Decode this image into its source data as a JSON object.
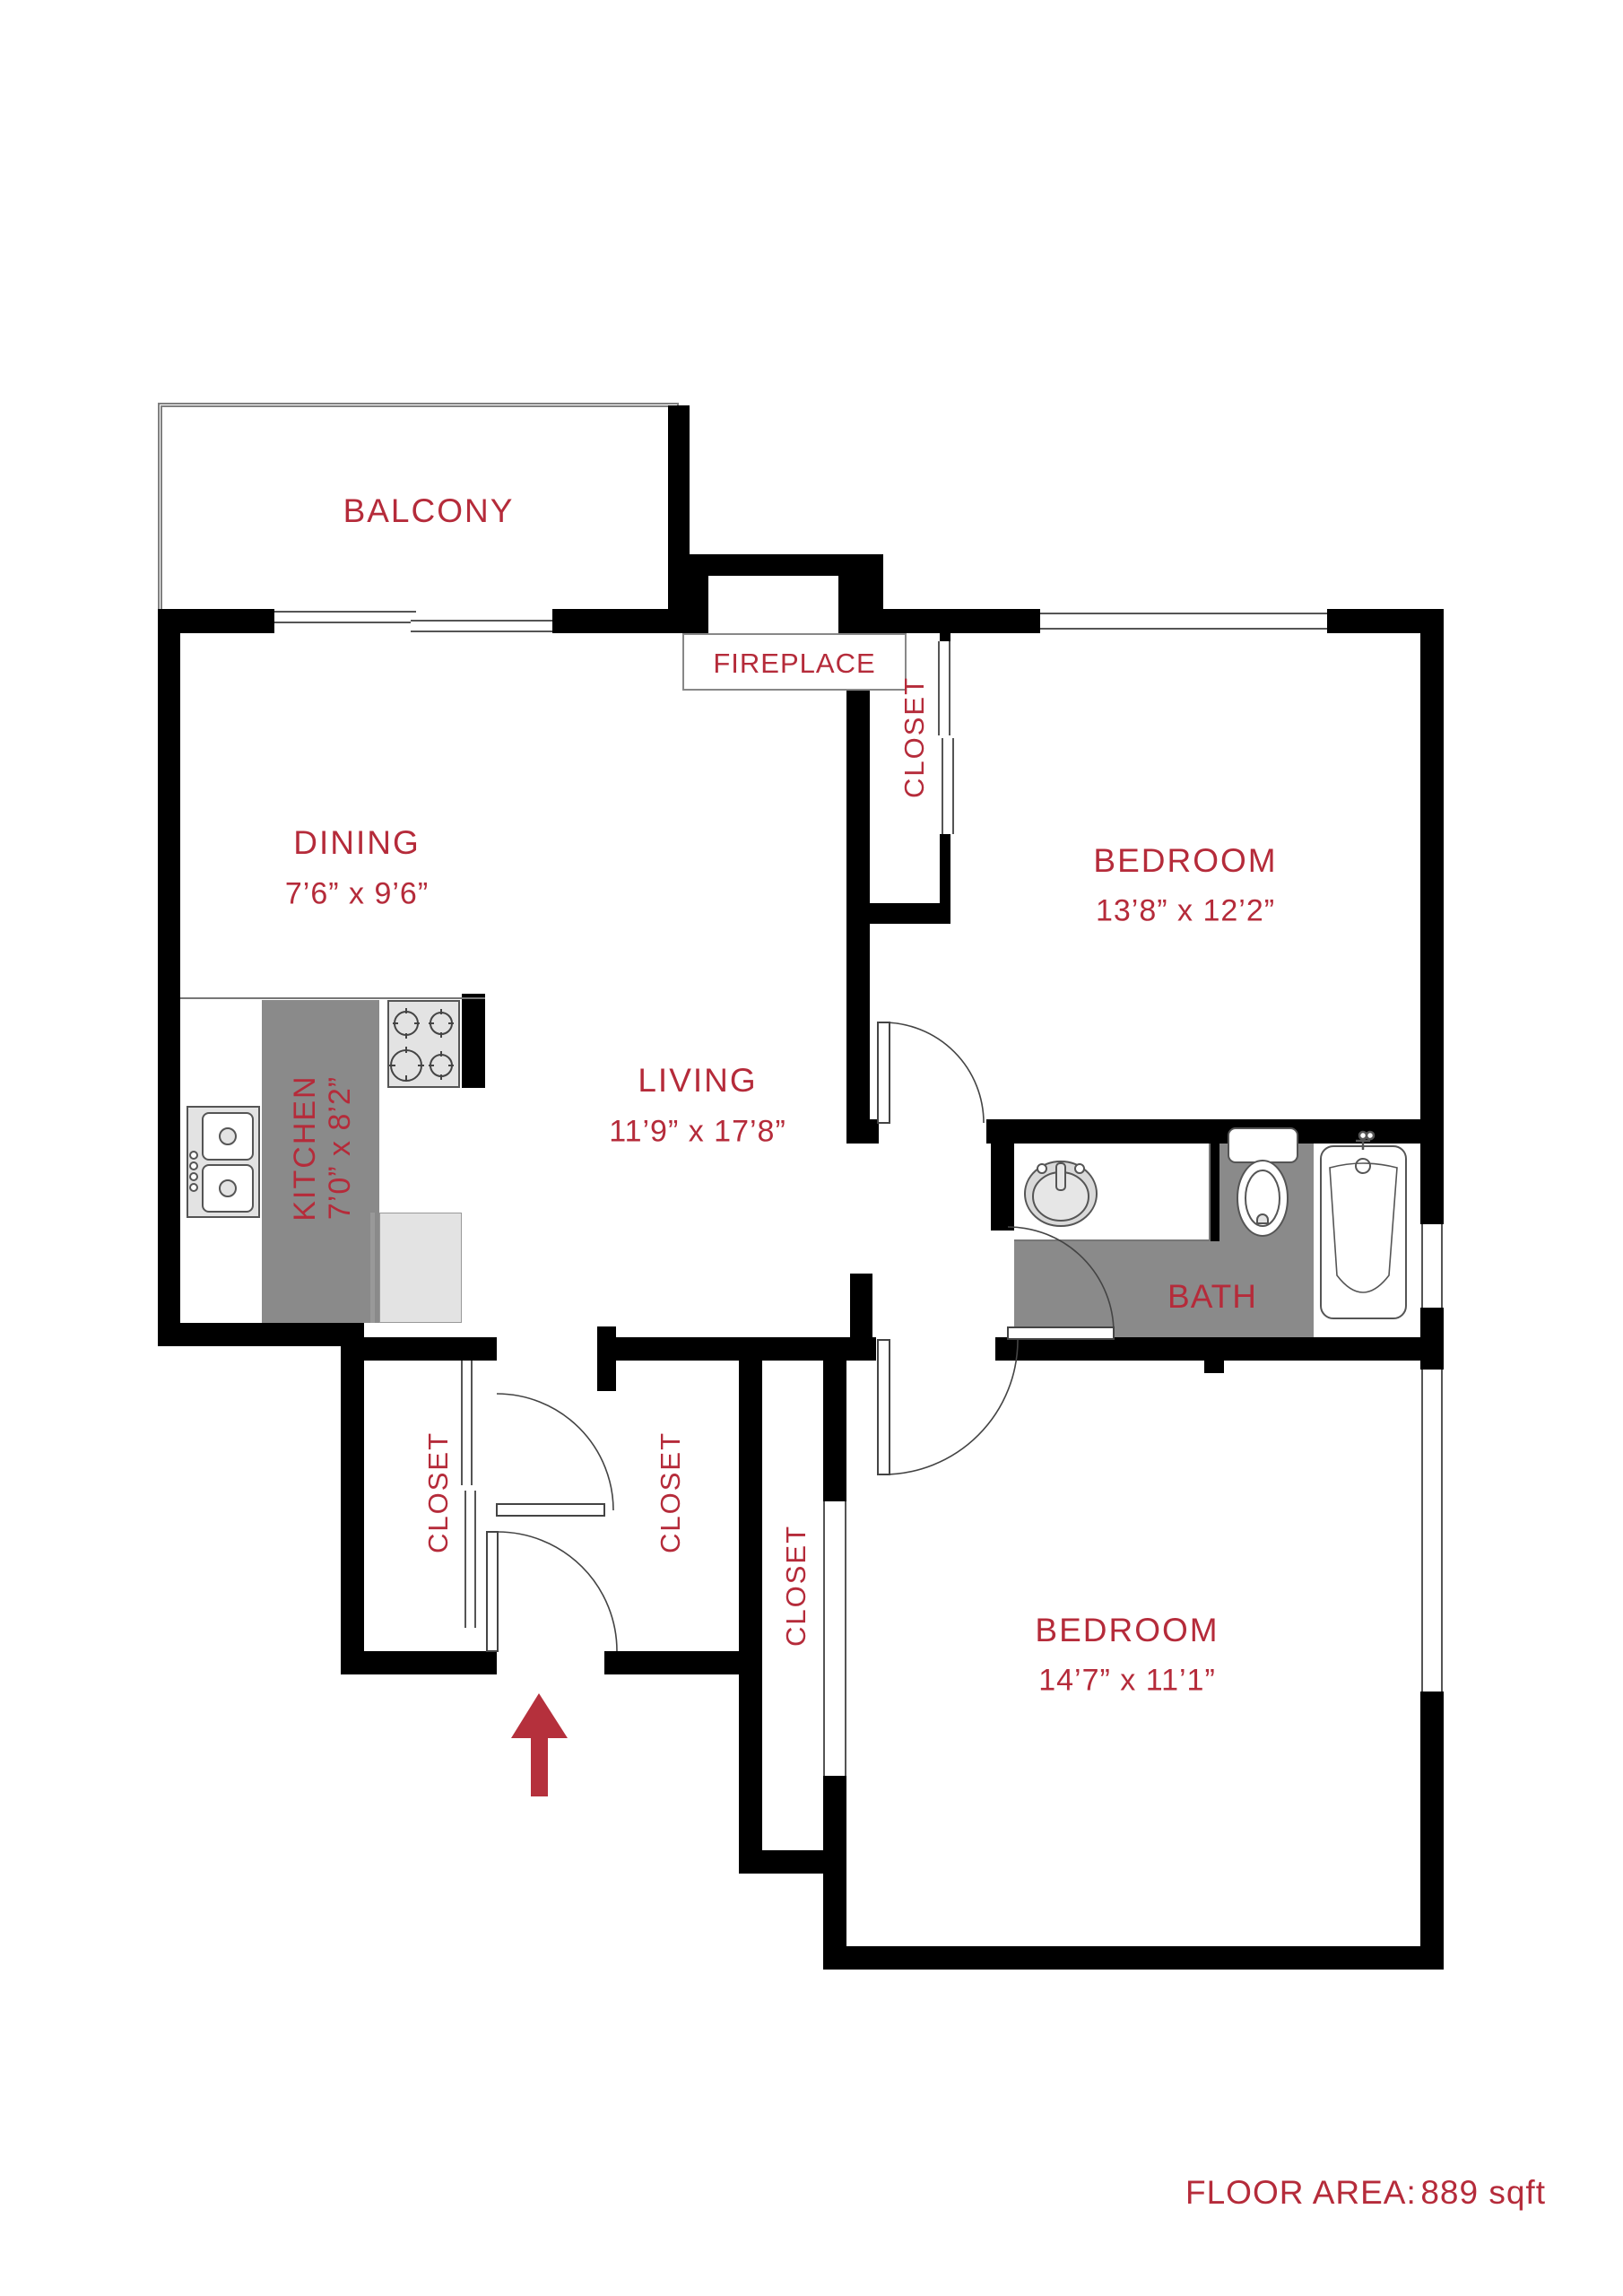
{
  "document": {
    "type": "apartment floor plan"
  },
  "colors": {
    "accent_red": "#b52b3a",
    "wall_black": "#000000",
    "floor_gray": "#8a8a8a",
    "fixture_gray": "#e3e3e3"
  },
  "rooms": {
    "balcony": {
      "label": "BALCONY"
    },
    "fireplace": {
      "label": "FIREPLACE"
    },
    "dining": {
      "label": "DINING",
      "dims": "7’6” x 9’6”"
    },
    "living": {
      "label": "LIVING",
      "dims": "11’9” x 17’8”"
    },
    "kitchen": {
      "label": "KITCHEN",
      "dims": "7’0” x 8’2”"
    },
    "bedroom1": {
      "label": "BEDROOM",
      "dims": "13’8” x 12’2”"
    },
    "bath": {
      "label": "BATH"
    },
    "bedroom2": {
      "label": "BEDROOM",
      "dims": "14’7” x 11’1”"
    }
  },
  "closets": [
    {
      "label": "CLOSET"
    },
    {
      "label": "CLOSET"
    },
    {
      "label": "CLOSET"
    },
    {
      "label": "CLOSET"
    }
  ],
  "footer": {
    "label": "FLOOR AREA:",
    "value": "889 sqft"
  }
}
